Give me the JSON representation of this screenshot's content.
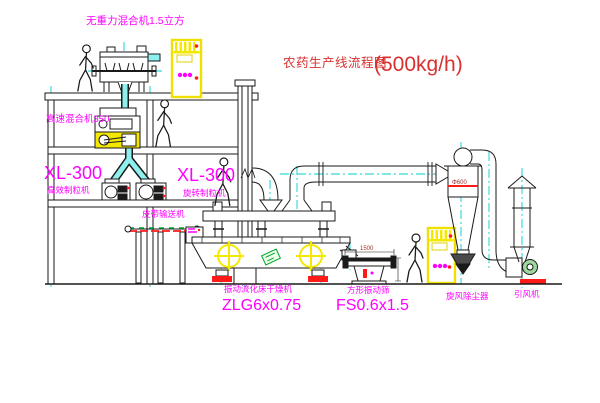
{
  "title": {
    "text": "农药生产线流程图",
    "capacity": "(500kg/h)"
  },
  "equipment_labels": {
    "gravity_mixer": "无重力混合机1.5立方",
    "high_speed_mixer": "高速混合机350",
    "granulator_left_model": "XL-300",
    "granulator_left_name": "高效制粒机",
    "granulator_right_model": "XL-300",
    "granulator_right_name": "旋转制粒机",
    "belt_conveyor": "皮带输送机",
    "fluid_bed_dryer_name": "振动流化床干燥机",
    "fluid_bed_dryer_model": "ZLG6x0.75",
    "vibrating_screen_name": "方形振动筛",
    "vibrating_screen_model": "FS0.6x1.5",
    "cyclone_collector": "旋风除尘器",
    "induced_draft_fan": "引风机"
  },
  "dimensions": {
    "screen_width": "1500",
    "cyclone_diameter": "Φ600"
  },
  "colors": {
    "background": "#ffffff",
    "line": "#1a1a1a",
    "centerline": "#00cfcf",
    "label_magenta": "#ff00ff",
    "title_red": "#d93030",
    "highlight_yellow": "#f5e800",
    "accent_red": "#ff1a1a",
    "accent_green": "#00a42a",
    "pipe_cyan": "#8ef0ee"
  }
}
